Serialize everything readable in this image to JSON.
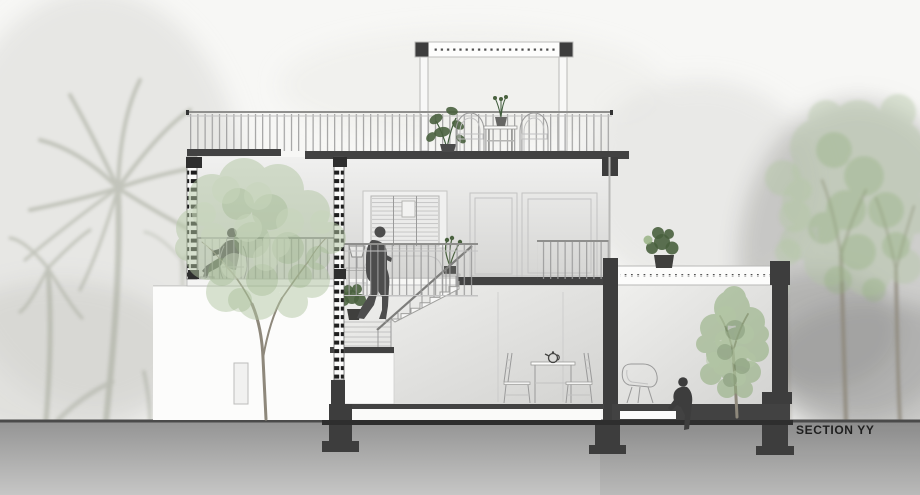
{
  "title": {
    "label": "SECTION YY"
  },
  "colors": {
    "paper": "#f7f7f5",
    "cut": "#3d3d3d",
    "cut-dark": "#2e2e2e",
    "slab": "#424242",
    "white": "#fdfdfd",
    "line": "#9a9a9a",
    "line-light": "#c2c2c2",
    "wall-top": "#f0f0ef",
    "wall-bottom": "#d5d5d3",
    "ground-top": "#949494",
    "ground-bottom": "#c6c6c5",
    "ground-line": "#4a4a4a",
    "silhouette": "#4d4d4d",
    "foliage-light": "#c8d6bc",
    "foliage-pale": "#b3c7a4",
    "foliage-mid": "#93af80",
    "foliage-dark": "#49613e",
    "trunk": "#8e887b",
    "palm": "#a4a89a",
    "fog": "#a0a09e",
    "text": "#1f1f1f"
  }
}
